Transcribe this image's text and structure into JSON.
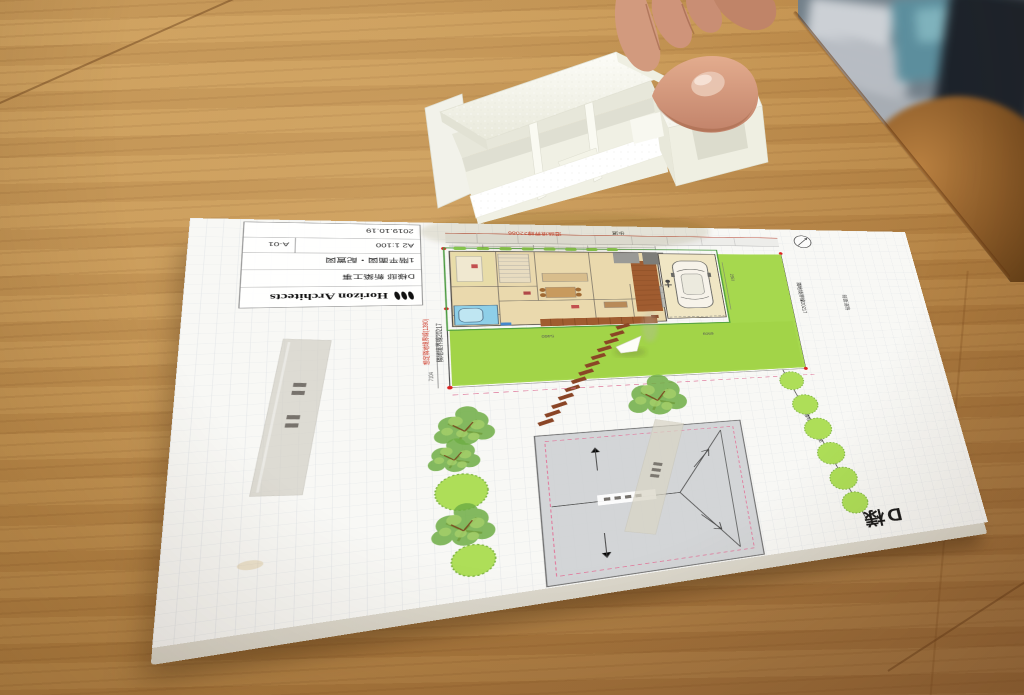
{
  "title_block": {
    "logo_text": "Horizon Architects",
    "rows": {
      "project": "D様邸 新築工事",
      "drawing": "1階平面図・配置図",
      "scale": "A2 1:100",
      "number": "A-01",
      "date": "2019.10.19"
    }
  },
  "site_plan": {
    "labels": {
      "road_boundary": "道路境界線22086",
      "sidewalk": "歩道",
      "assumed_boundary_left": "想定隣地境界線(1390)",
      "neighbor_boundary_left": "隣地境界線20217",
      "neighbor_boundary_right": "隣地境界線20217",
      "neighbor_boundary_lower_right": "隣地境界線22086",
      "front_road": "前面道路",
      "client": "D様"
    },
    "dimensions": {
      "left_side": "7104",
      "garage_side": "2550",
      "lawn_a": "5460",
      "lawn_b": "6909"
    },
    "colors": {
      "lawn": "#a6d84e",
      "bush": "#aede58",
      "roof_gray": "#d0d3d5",
      "deck_brown": "#a05c30",
      "bath_blue": "#8ecfe8",
      "room_beige": "#ead9ad",
      "boundary_red": "#cc3322",
      "setback_pink": "#e080a0"
    }
  },
  "photo": {
    "colors": {
      "desk_wood": "#b8874a",
      "foam_white": "#f6f6ec",
      "skin": "#d5a083",
      "chair_brown": "#8a5a28"
    }
  }
}
